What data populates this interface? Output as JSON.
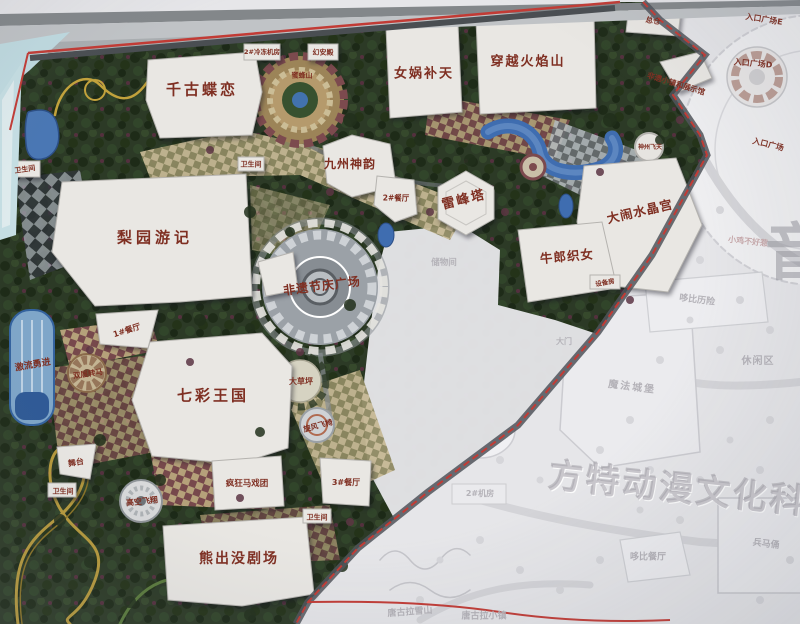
{
  "park_map": {
    "watermarks": {
      "brand": "方特动漫文化科技",
      "side": "音"
    },
    "attractions": [
      {
        "label": "千古蝶恋"
      },
      {
        "label": "女娲补天"
      },
      {
        "label": "穿越火焰山"
      },
      {
        "label": "九州神韵"
      },
      {
        "label": "梨园游记"
      },
      {
        "label": "雷峰塔"
      },
      {
        "label": "非遗节庆广场"
      },
      {
        "label": "大闹水晶宫"
      },
      {
        "label": "牛郎织女"
      },
      {
        "label": "七彩王国"
      },
      {
        "label": "熊出没剧场"
      },
      {
        "label": "激流勇进"
      },
      {
        "label": "双层转马"
      },
      {
        "label": "大草坪"
      },
      {
        "label": "旋风飞椅"
      },
      {
        "label": "高空飞翔"
      },
      {
        "label": "疯狂马戏团"
      },
      {
        "label": "舞台"
      },
      {
        "label": "蜜蜂山"
      },
      {
        "label": "神州飞天"
      },
      {
        "label": "非遗小镇和展示馆"
      },
      {
        "label": "幻安殿"
      }
    ],
    "facilities": [
      {
        "label": "总仓"
      },
      {
        "label": "2#冷冻机房"
      },
      {
        "label": "1#餐厅"
      },
      {
        "label": "2#餐厅"
      },
      {
        "label": "3#餐厅"
      },
      {
        "label": "卫生间"
      },
      {
        "label": "卫生间"
      },
      {
        "label": "卫生间"
      },
      {
        "label": "卫生间"
      },
      {
        "label": "设备房"
      },
      {
        "label": "储物间"
      },
      {
        "label": "2#机房"
      }
    ],
    "entrances": [
      {
        "label": "入口广场E"
      },
      {
        "label": "入口广场D"
      },
      {
        "label": "入口广场"
      },
      {
        "label": "大门"
      }
    ],
    "adjacent_area": [
      {
        "label": "魔法城堡"
      },
      {
        "label": "休闲区"
      },
      {
        "label": "哆比历险"
      },
      {
        "label": "哆比餐厅"
      },
      {
        "label": "兵马俑"
      },
      {
        "label": "唐古拉雪山"
      },
      {
        "label": "唐古拉小镇"
      },
      {
        "label": "小鸡不好惹"
      }
    ],
    "colors": {
      "boundary_red": "#c23b35",
      "water": "#3f6db0",
      "foliage": "#2c3a26",
      "building": "#e9e7e3",
      "label_red": "#7f2f22",
      "faded_text": "#b4b2b8"
    }
  }
}
